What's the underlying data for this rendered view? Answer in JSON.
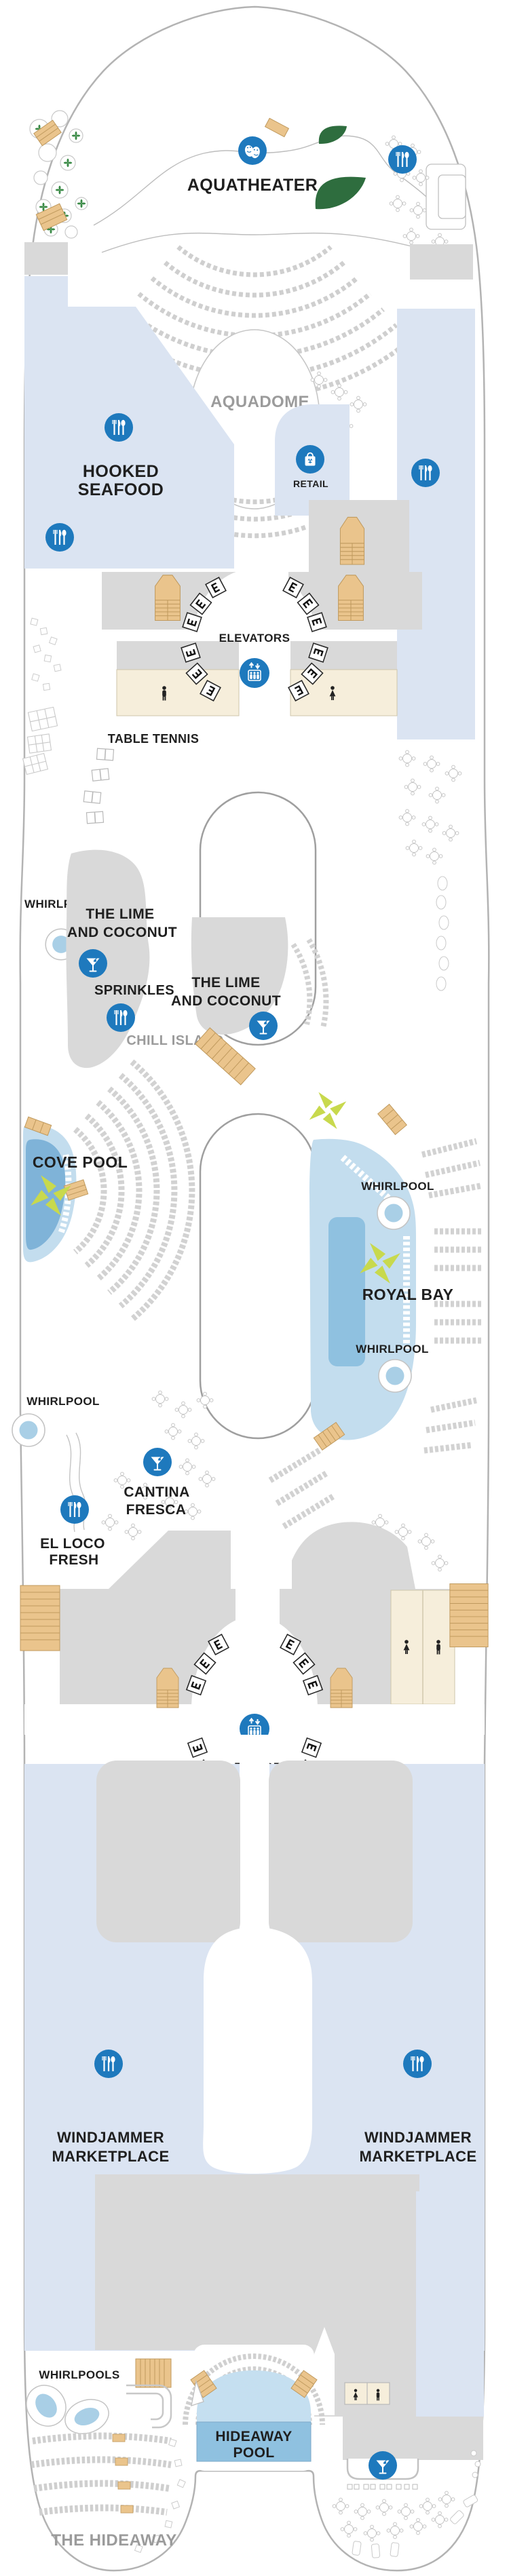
{
  "page": {
    "title": "Cruise ship pool deck plan"
  },
  "colors": {
    "icon_blue": "#1e79bd",
    "label_black": "#1f1f1f",
    "label_gray": "#9b9b9b",
    "area_light_blue": "#dbe4f2",
    "structure_gray": "#d9d9d9",
    "restroom_cream": "#f6eedb",
    "stair_tan": "#eac48c",
    "pool_light": "#c3ddee",
    "pool_mid": "#a9cfe6",
    "pool_deep": "#8fc1e0",
    "landscape_green": "#2e6d3e",
    "umbrella_lime": "#c8d94d",
    "hull_outline": "#b3b3b3",
    "furniture_gray": "#c9c9c9"
  },
  "areas": {
    "aquatheater": {
      "label": "AQUATHEATER"
    },
    "aquadome": {
      "label": "AQUADOME"
    },
    "hooked_seafood": {
      "line1": "HOOKED",
      "line2": "SEAFOOD"
    },
    "retail": {
      "label": "RETAIL"
    },
    "elevators_forward": {
      "label": "ELEVATORS"
    },
    "table_tennis": {
      "label": "TABLE TENNIS"
    },
    "whirlpool_port_forward": {
      "label": "WHIRLPOOL"
    },
    "lime_and_coconut_port": {
      "line1": "THE LIME",
      "line2": "AND COCONUT"
    },
    "sprinkles": {
      "label": "SPRINKLES"
    },
    "lime_and_coconut_starboard": {
      "line1": "THE LIME",
      "line2": "AND COCONUT"
    },
    "chill_island": {
      "label": "CHILL ISLAND"
    },
    "cove_pool": {
      "label": "COVE POOL"
    },
    "royal_bay": {
      "label": "ROYAL BAY"
    },
    "whirlpool_royal_bay_forward": {
      "label": "WHIRLPOOL"
    },
    "whirlpool_royal_bay_aft": {
      "label": "WHIRLPOOL"
    },
    "whirlpool_port_mid": {
      "label": "WHIRLPOOL"
    },
    "cantina_fresca": {
      "line1": "CANTINA",
      "line2": "FRESCA"
    },
    "el_loco_fresh": {
      "line1": "EL LOCO",
      "line2": "FRESH"
    },
    "elevators_aft": {
      "label": "ELEVATORS"
    },
    "windjammer_port": {
      "line1": "WINDJAMMER",
      "line2": "MARKETPLACE"
    },
    "windjammer_starboard": {
      "line1": "WINDJAMMER",
      "line2": "MARKETPLACE"
    },
    "whirlpools_aft": {
      "label": "WHIRLPOOLS"
    },
    "hideaway_pool": {
      "line1": "HIDEAWAY",
      "line2": "POOL"
    },
    "the_hideaway": {
      "label": "THE HIDEAWAY"
    }
  },
  "icons": {
    "theater_masks": "theater masks (aqua show)",
    "dining": "fork, knife and spoon (restaurant)",
    "bar": "martini glass (bar)",
    "retail_bag": "shopping bag (retail)",
    "elevator": "elevator cab with up and down arrows",
    "restroom_man": "man silhouette (restroom)",
    "restroom_woman": "woman silhouette (restroom)",
    "elevator_tile_letter": "E",
    "umbrella": "pool umbrella",
    "whirlpool_tub": "whirlpool"
  }
}
